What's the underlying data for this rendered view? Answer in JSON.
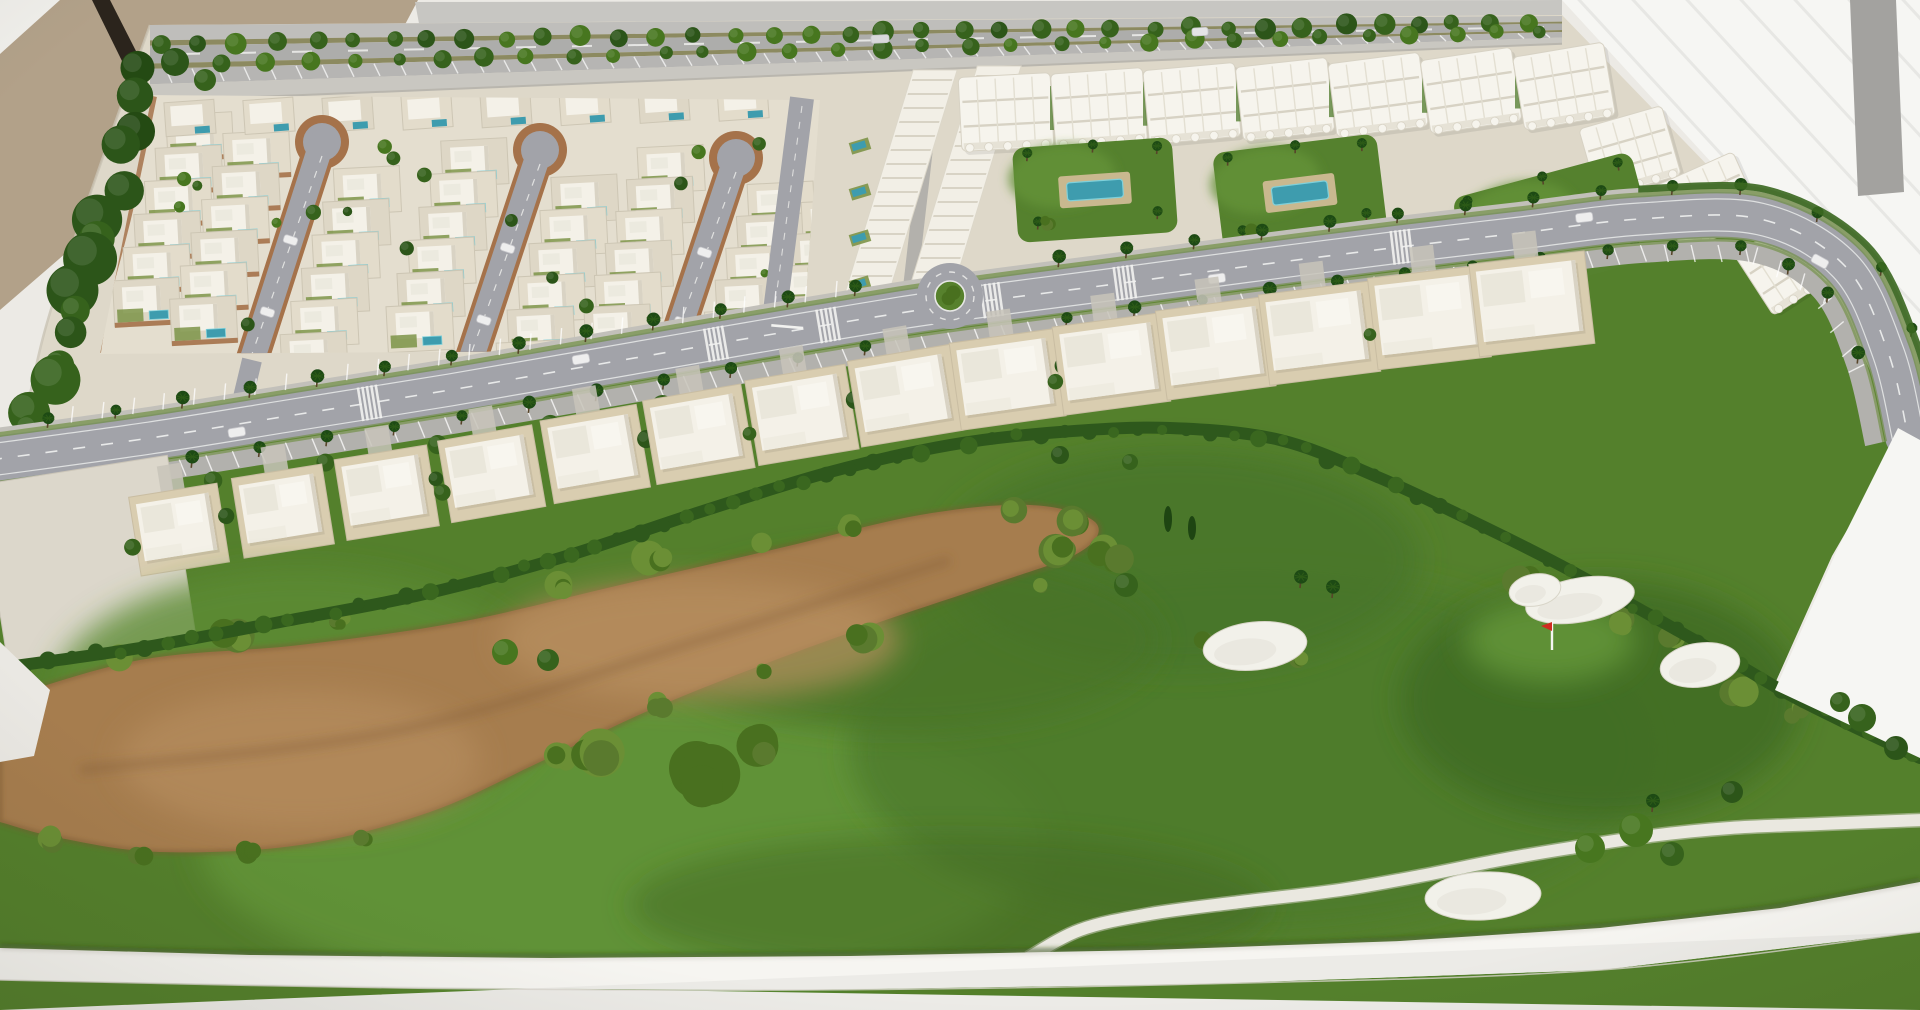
{
  "scene": {
    "type": "photograph",
    "subject": "architectural scale model (maquette) of a golf-resort residential development on a white display table",
    "elements": [
      "villa district with three loop cul-de-sac streets, white villas and private pools",
      "terraced townhouse strip",
      "three-storey apartment blocks with garden courtyards and communal pools",
      "palm-lined curving boulevard with roundabout, parking bays, crosswalks and model cars",
      "curved row of two-storey townhouses facing the golf course",
      "golf course with fairway, brown waste area, sand bunkers, red flag and white cart path",
      "tan wall and bright white backdrop behind the table"
    ]
  },
  "palette": {
    "table": "#eceae5",
    "tableBright": "#f2f1ed",
    "wall": "#b2a189",
    "rod": "#2b241c",
    "bgGray": "#c7c6c2",
    "backdrop": "#f6f6f3",
    "backdropLine": "#e4e4e0",
    "grayBand": "#a3a29f",
    "base": "#ded8c9",
    "zoneBase": "#e4decf",
    "asphalt": "#a2a3a9",
    "asphaltLight": "#adadab",
    "sidewalk": "#c2c0ba",
    "parking": "#b2b1ad",
    "roadLine": "#eeefed",
    "brick": "#a5724a",
    "villa": "#f4f1e8",
    "villaShade": "#d9d3c4",
    "lot": "#ded7c6",
    "lotAlt": "#e3dccb",
    "lotLine": "#cdc6b4",
    "pool": "#3e9cae",
    "poolLight": "#7fd0da",
    "lawn": "#7d9448",
    "block": "#f6f4ed",
    "blockLine": "#d7d2c4",
    "blockShade": "#e6e2d6",
    "garden": "#55812e",
    "gardenLight": "#649238",
    "deck": "#c9b88f",
    "green": "#54802c",
    "greenDark": "#3a651f",
    "greenDarker": "#2e4f18",
    "hedge": "#2e581c",
    "hedge2": "#3a671f",
    "dirt": "#a67d4e",
    "dirtLight": "#b8905f",
    "dirtDark": "#7d5a34",
    "bush1": "#5a7a2e",
    "bush2": "#6b8f35",
    "bush3": "#49701f",
    "tree1": "#2c5519",
    "tree2": "#47761f",
    "tree3": "#36621c",
    "cypress": "#1e4512",
    "palm": "#1d4a14",
    "trunk": "#574429",
    "bunker": "#f2f1ea",
    "cartPath": "#eae8e0",
    "flagRed": "#cf2b20",
    "car": "#eeeeee",
    "carShade": "#c6c6ca",
    "rim": "#f6f5f1",
    "rimShadow": "#aaa69b",
    "houseLot": "#d9cdb0",
    "drive": "#c8c4ba",
    "emptyLot": "#dcd7cb"
  },
  "layout": {
    "seed": 7,
    "wall": [
      [
        0,
        0
      ],
      [
        418,
        0
      ],
      [
        400,
        34
      ],
      [
        162,
        170
      ],
      [
        0,
        310
      ]
    ],
    "cornerTri": [
      [
        0,
        0
      ],
      [
        60,
        0
      ],
      [
        0,
        54
      ]
    ],
    "rod": [
      [
        92,
        0
      ],
      [
        110,
        0
      ],
      [
        224,
        224
      ],
      [
        206,
        232
      ]
    ],
    "grayTop": [
      [
        415,
        2
      ],
      [
        1562,
        0
      ],
      [
        1562,
        16
      ],
      [
        428,
        72
      ]
    ],
    "backdrop": [
      [
        1562,
        0
      ],
      [
        1920,
        0
      ],
      [
        1920,
        442
      ],
      [
        1898,
        430
      ],
      [
        1838,
        300
      ]
    ],
    "wedge2": [
      [
        1898,
        428
      ],
      [
        1920,
        440
      ],
      [
        1920,
        758
      ],
      [
        1775,
        690
      ],
      [
        1838,
        548
      ]
    ],
    "grayBand": [
      [
        1850,
        0
      ],
      [
        1896,
        0
      ],
      [
        1904,
        192
      ],
      [
        1858,
        196
      ]
    ],
    "northBase": [
      [
        150,
        25
      ],
      [
        1562,
        15
      ],
      [
        1838,
        300
      ],
      [
        1898,
        432
      ],
      [
        1840,
        270
      ],
      [
        1750,
        214
      ],
      [
        1620,
        212
      ],
      [
        1450,
        232
      ],
      [
        1250,
        260
      ],
      [
        1000,
        298
      ],
      [
        750,
        338
      ],
      [
        500,
        378
      ],
      [
        250,
        415
      ],
      [
        0,
        455
      ],
      [
        15,
        470
      ],
      [
        45,
        330
      ],
      [
        95,
        180
      ]
    ],
    "underlay": [
      [
        0,
        472
      ],
      [
        250,
        430
      ],
      [
        500,
        392
      ],
      [
        750,
        352
      ],
      [
        1000,
        310
      ],
      [
        1250,
        272
      ],
      [
        1450,
        245
      ],
      [
        1620,
        225
      ],
      [
        1750,
        228
      ],
      [
        1850,
        290
      ],
      [
        1905,
        430
      ],
      [
        1832,
        556
      ],
      [
        1772,
        690
      ],
      [
        1920,
        760
      ],
      [
        1920,
        1010
      ],
      [
        0,
        1010
      ]
    ],
    "road": [
      [
        -10,
        460
      ],
      [
        150,
        438
      ],
      [
        300,
        414
      ],
      [
        450,
        390
      ],
      [
        600,
        364
      ],
      [
        750,
        338
      ],
      [
        900,
        313
      ],
      [
        1000,
        299
      ],
      [
        1100,
        286
      ],
      [
        1250,
        266
      ],
      [
        1400,
        247
      ],
      [
        1520,
        233
      ],
      [
        1640,
        219
      ],
      [
        1760,
        219
      ],
      [
        1845,
        266
      ],
      [
        1888,
        352
      ],
      [
        1908,
        436
      ]
    ],
    "roundabout": {
      "x": 950,
      "y": 296
    },
    "secondary": {
      "a": [
        802,
        98
      ],
      "b": [
        772,
        335
      ]
    },
    "stubs": [
      [
        [
          252,
          360
        ],
        [
          240,
          410
        ]
      ],
      [
        [
          468,
          368
        ],
        [
          456,
          398
        ]
      ]
    ],
    "crosswalkT": [
      0.185,
      0.355,
      0.41,
      0.49,
      0.555,
      0.69
    ],
    "carsRoad": [
      [
        0.12,
        -8
      ],
      [
        0.29,
        8
      ],
      [
        0.6,
        -8
      ],
      [
        0.78,
        8
      ],
      [
        0.9,
        -8
      ]
    ],
    "housesT": [
      0.085,
      0.136,
      0.187,
      0.238,
      0.289,
      0.34,
      0.391,
      0.442,
      0.493,
      0.544,
      0.595,
      0.646,
      0.7,
      0.75
    ],
    "emptyLot": {
      "x": 88,
      "y": 562,
      "w": 190,
      "h": 186,
      "rot": -9
    },
    "hedge": [
      [
        0,
        668
      ],
      [
        140,
        648
      ],
      [
        280,
        622
      ],
      [
        420,
        595
      ],
      [
        560,
        558
      ],
      [
        700,
        512
      ],
      [
        830,
        472
      ],
      [
        950,
        445
      ],
      [
        1060,
        432
      ],
      [
        1170,
        428
      ],
      [
        1280,
        440
      ],
      [
        1380,
        478
      ],
      [
        1470,
        520
      ],
      [
        1560,
        565
      ],
      [
        1650,
        615
      ],
      [
        1730,
        660
      ],
      [
        1790,
        695
      ],
      [
        1850,
        725
      ],
      [
        1920,
        758
      ]
    ],
    "dirt": [
      [
        0,
        700
      ],
      [
        140,
        660
      ],
      [
        300,
        645
      ],
      [
        460,
        622
      ],
      [
        620,
        585
      ],
      [
        780,
        548
      ],
      [
        920,
        515
      ],
      [
        1030,
        505
      ],
      [
        1095,
        522
      ],
      [
        1080,
        552
      ],
      [
        990,
        585
      ],
      [
        880,
        622
      ],
      [
        770,
        662
      ],
      [
        650,
        710
      ],
      [
        540,
        762
      ],
      [
        430,
        812
      ],
      [
        300,
        845
      ],
      [
        160,
        852
      ],
      [
        60,
        838
      ],
      [
        0,
        822
      ]
    ],
    "mounds": [
      [
        620,
        845,
        420,
        150,
        "#639336",
        0.9
      ],
      [
        300,
        700,
        250,
        130,
        "#5d8c33",
        0.8
      ],
      [
        1250,
        750,
        400,
        180,
        "#4e7a29",
        0.8
      ],
      [
        1180,
        560,
        240,
        110,
        "#477329",
        0.7
      ],
      [
        1600,
        700,
        200,
        120,
        "#3f6a24",
        0.75
      ],
      [
        900,
        640,
        260,
        90,
        "#47732a",
        0.6
      ],
      [
        1550,
        640,
        85,
        42,
        "#639336",
        0.9
      ],
      [
        950,
        905,
        320,
        70,
        "#3f6a24",
        0.5
      ]
    ],
    "bushEdge": [
      [
        120,
        655
      ],
      [
        230,
        638
      ],
      [
        340,
        622
      ],
      [
        450,
        605
      ],
      [
        560,
        585
      ],
      [
        660,
        560
      ],
      [
        760,
        540
      ],
      [
        850,
        525
      ],
      [
        930,
        512
      ],
      [
        1010,
        505
      ],
      [
        1070,
        520
      ],
      [
        1100,
        548
      ],
      [
        1040,
        585
      ],
      [
        950,
        605
      ],
      [
        860,
        635
      ],
      [
        760,
        672
      ],
      [
        660,
        705
      ],
      [
        560,
        755
      ],
      [
        470,
        800
      ],
      [
        360,
        838
      ],
      [
        250,
        852
      ],
      [
        140,
        855
      ],
      [
        50,
        840
      ]
    ],
    "clusters": [
      [
        690,
        778,
        5,
        30
      ],
      [
        590,
        758,
        4,
        24
      ],
      [
        760,
        748,
        3,
        20
      ],
      [
        1060,
        545,
        4,
        18
      ],
      [
        1120,
        560,
        3,
        14
      ],
      [
        1672,
        640,
        3,
        14
      ],
      [
        1740,
        690,
        4,
        16
      ],
      [
        1520,
        578,
        4,
        15
      ],
      [
        1620,
        622,
        3,
        13
      ],
      [
        1205,
        640,
        3,
        12
      ],
      [
        1300,
        660,
        3,
        11
      ],
      [
        1800,
        712,
        3,
        13
      ]
    ],
    "bunkers": [
      [
        1255,
        646,
        52,
        24,
        -6
      ],
      [
        1580,
        600,
        55,
        22,
        -10
      ],
      [
        1535,
        590,
        26,
        16,
        -10
      ],
      [
        1700,
        665,
        40,
        22,
        -8
      ],
      [
        1483,
        896,
        58,
        24,
        -3
      ]
    ],
    "flag": {
      "x": 1552,
      "y": 628
    },
    "cart": [
      [
        1028,
        958
      ],
      [
        1080,
        930
      ],
      [
        1150,
        914
      ],
      [
        1240,
        902
      ],
      [
        1340,
        890
      ],
      [
        1420,
        876
      ],
      [
        1500,
        860
      ],
      [
        1570,
        848
      ],
      [
        1650,
        836
      ],
      [
        1730,
        828
      ],
      [
        1820,
        824
      ],
      [
        1922,
        820
      ]
    ],
    "golfTrees": [
      [
        505,
        652,
        13
      ],
      [
        548,
        660,
        11
      ],
      [
        1126,
        585,
        12
      ],
      [
        1060,
        455,
        9
      ],
      [
        1130,
        462,
        8
      ],
      [
        1590,
        848,
        15
      ],
      [
        1636,
        830,
        17
      ],
      [
        1672,
        854,
        12
      ],
      [
        1732,
        792,
        11
      ],
      [
        1862,
        718,
        14
      ],
      [
        1896,
        748,
        12
      ],
      [
        1840,
        702,
        10
      ]
    ],
    "golfPalms": [
      [
        1300,
        588
      ],
      [
        1332,
        598
      ],
      [
        1652,
        812
      ]
    ],
    "cypresses": [
      [
        1168,
        532,
        26
      ],
      [
        1192,
        540,
        24
      ]
    ],
    "streets": {
      "heads": [
        [
          322,
          142
        ],
        [
          540,
          150
        ],
        [
          736,
          158
        ]
      ],
      "feet": [
        [
          252,
          360
        ],
        [
          468,
          368
        ],
        [
          666,
          368
        ]
      ],
      "cols": [
        [
          -118,
          -58,
          58
        ],
        [
          -58,
          58
        ],
        [
          -58,
          58,
          115
        ]
      ]
    },
    "villaClip": [
      [
        152,
        95
      ],
      [
        820,
        100
      ],
      [
        802,
        350
      ],
      [
        100,
        354
      ]
    ],
    "leftTreesLine": [
      [
        150,
        75
      ],
      [
        18,
        468
      ]
    ],
    "terraces": [
      [
        900,
        185,
        44,
        230
      ],
      [
        965,
        178,
        44,
        224
      ]
    ],
    "aptWing": [
      [
        1630,
        152,
        -16
      ],
      [
        1708,
        202,
        -24
      ],
      [
        1790,
        262,
        -33
      ]
    ],
    "gardens": [
      {
        "x": 1095,
        "y": 190,
        "w": 160,
        "h": 95,
        "rot": -4
      },
      {
        "x": 1300,
        "y": 193,
        "w": 165,
        "h": 100,
        "rot": -7
      },
      {
        "x": 1555,
        "y": 228,
        "w": 185,
        "h": 110,
        "rot": -15
      }
    ],
    "highway": {
      "x0": 150,
      "x1": 1562,
      "yT0": 25,
      "yT1": 16,
      "yB0": 102,
      "yB1": 44,
      "bands": [
        [
          0,
          0.2,
          "#bfbebb"
        ],
        [
          0.2,
          0.27,
          "#8c8a60"
        ],
        [
          0.27,
          0.5,
          "#adadab"
        ],
        [
          0.5,
          0.57,
          "#8c8a60"
        ],
        [
          0.57,
          0.77,
          "#b6b5b3"
        ],
        [
          0.77,
          1,
          "#c9c7c1"
        ]
      ]
    },
    "rimTop": [
      [
        0,
        948
      ],
      [
        250,
        955
      ],
      [
        550,
        958
      ],
      [
        850,
        956
      ],
      [
        1150,
        950
      ],
      [
        1400,
        941
      ],
      [
        1600,
        928
      ],
      [
        1780,
        908
      ],
      [
        1920,
        882
      ]
    ],
    "rimBot": [
      [
        1920,
        932
      ],
      [
        1600,
        970
      ],
      [
        1200,
        984
      ],
      [
        800,
        990
      ],
      [
        400,
        988
      ],
      [
        0,
        980
      ]
    ]
  }
}
